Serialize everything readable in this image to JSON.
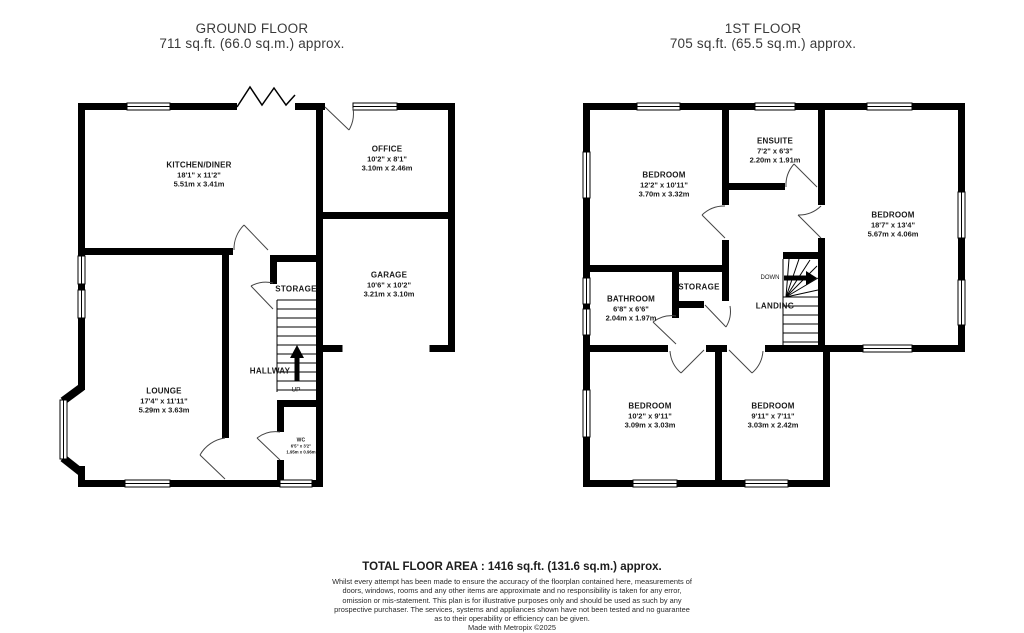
{
  "titles": {
    "ground_floor": {
      "name": "GROUND FLOOR",
      "area": "711 sq.ft. (66.0 sq.m.) approx."
    },
    "first_floor": {
      "name": "1ST FLOOR",
      "area": "705 sq.ft. (65.5 sq.m.) approx."
    }
  },
  "ground_floor": {
    "rooms": {
      "kitchen": {
        "name": "KITCHEN/DINER",
        "imperial": "18'1\" x 11'2\"",
        "metric": "5.51m x 3.41m"
      },
      "office": {
        "name": "OFFICE",
        "imperial": "10'2\" x 8'1\"",
        "metric": "3.10m x 2.46m"
      },
      "garage": {
        "name": "GARAGE",
        "imperial": "10'6\" x 10'2\"",
        "metric": "3.21m x 3.10m"
      },
      "lounge": {
        "name": "LOUNGE",
        "imperial": "17'4\" x 11'11\"",
        "metric": "5.29m x 3.63m"
      },
      "wc": {
        "name": "WC",
        "imperial": "6'5\" x 3'2\"",
        "metric": "1.95m x 0.96m"
      }
    },
    "labels": {
      "storage": "STORAGE",
      "hallway": "HALLWAY",
      "up": "UP"
    }
  },
  "first_floor": {
    "rooms": {
      "bedroom_1": {
        "name": "BEDROOM",
        "imperial": "12'2\" x 10'11\"",
        "metric": "3.70m x 3.32m"
      },
      "ensuite": {
        "name": "ENSUITE",
        "imperial": "7'2\" x 6'3\"",
        "metric": "2.20m x 1.91m"
      },
      "bedroom_2": {
        "name": "BEDROOM",
        "imperial": "18'7\" x 13'4\"",
        "metric": "5.67m x 4.06m"
      },
      "bathroom": {
        "name": "BATHROOM",
        "imperial": "6'8\" x 6'6\"",
        "metric": "2.04m x 1.97m"
      },
      "bedroom_3": {
        "name": "BEDROOM",
        "imperial": "10'2\" x 9'11\"",
        "metric": "3.09m x 3.03m"
      },
      "bedroom_4": {
        "name": "BEDROOM",
        "imperial": "9'11\" x 7'11\"",
        "metric": "3.03m x 2.42m"
      }
    },
    "labels": {
      "storage": "STORAGE",
      "landing": "LANDING",
      "down": "DOWN"
    }
  },
  "footer": {
    "total": "TOTAL FLOOR AREA : 1416 sq.ft. (131.6 sq.m.) approx.",
    "disclaimer": "Whilst every attempt has been made to ensure the accuracy of the floorplan contained here, measurements of doors, windows, rooms and any other items are approximate and no responsibility is taken for any error, omission or mis-statement. This plan is for illustrative purposes only and should be used as such by any prospective purchaser. The services, systems and appliances shown have not been tested and no guarantee as to their operability or efficiency can be given.",
    "credit": "Made with Metropix ©2025"
  },
  "colors": {
    "wall": "#000000",
    "text": "#191919",
    "title_text": "#3a3a3a"
  }
}
